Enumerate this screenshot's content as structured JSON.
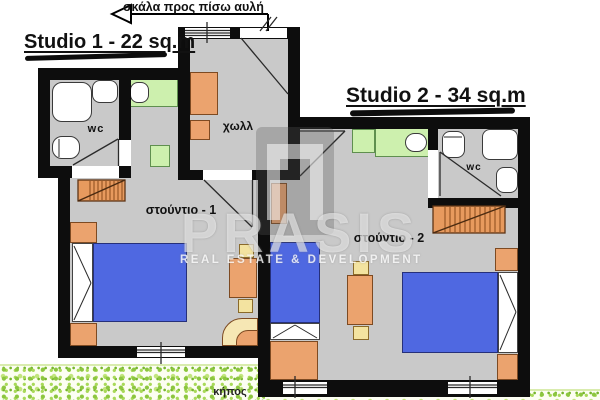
{
  "titles": {
    "studio1": "Studio 1 - 22 sq.m",
    "studio2": "Studio 2  - 34 sq.m"
  },
  "annotations": {
    "stairs_arrow": "σκάλα προς πίσω αυλή",
    "garden": "κήπος"
  },
  "rooms": {
    "hall": "χωλλ",
    "studio1": "στούντιο - 1",
    "studio2": "στούντιο - 2",
    "wc1": "wc",
    "wc2": "wc"
  },
  "watermark": {
    "name": "PRASIS",
    "tagline": "REAL ESTATE & DEVELOPMENT"
  },
  "colors": {
    "wall": "#0d0d0d",
    "floor": "#c9c9c9",
    "furniture_orange": "#eba36e",
    "bed_blue": "#4f68e1",
    "kitchen_green": "#cdf0ae",
    "seat_yellow": "#f3e3a0",
    "bench_cream": "#f6e7b4",
    "stairs_orange": "#e79a5e",
    "grass_green": "#8cc63f",
    "watermark_white": "#ffffff"
  }
}
